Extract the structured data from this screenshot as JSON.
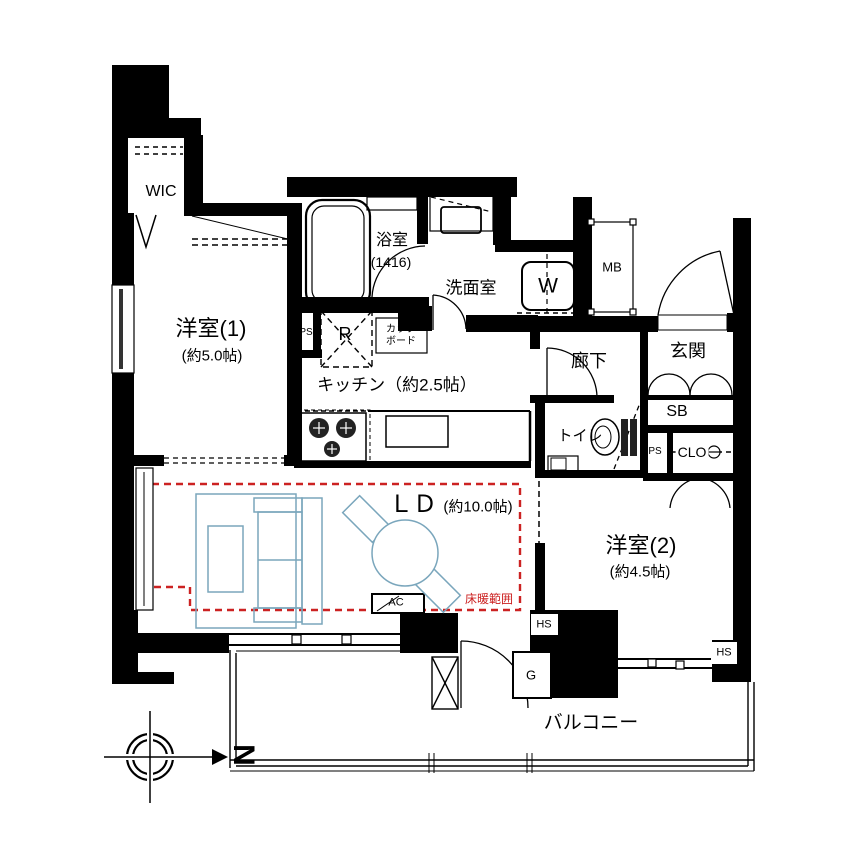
{
  "rooms": {
    "wic": {
      "label": "WIC"
    },
    "bedroom1": {
      "label": "洋室(1)",
      "size": "(約5.0帖)"
    },
    "bathroom": {
      "label": "浴室",
      "size": "(1416)"
    },
    "washroom": {
      "label": "洗面室"
    },
    "washing_machine": {
      "label": "W"
    },
    "meter_box": {
      "label": "MB"
    },
    "entrance": {
      "label": "玄関"
    },
    "hallway": {
      "label": "廊下"
    },
    "shoe_box": {
      "label": "SB"
    },
    "toilet": {
      "label": "トイレ"
    },
    "pipe_space_kitchen": {
      "label": "PS"
    },
    "pipe_space_hall": {
      "label": "PS"
    },
    "closet": {
      "label": "CLO"
    },
    "refrigerator_space": {
      "label": "R"
    },
    "cupboard": {
      "line1": "カップ",
      "line2": "ボード"
    },
    "kitchen": {
      "label": "キッチン（約2.5帖）"
    },
    "living_dining": {
      "label": "ＬＤ",
      "size": "(約10.0帖)"
    },
    "floor_heating": {
      "label": "床暖範囲"
    },
    "air_conditioner": {
      "label": "AC"
    },
    "bedroom2": {
      "label": "洋室(2)",
      "size": "(約4.5帖)"
    },
    "hose_spigot_left": {
      "label": "HS"
    },
    "hose_spigot_right": {
      "label": "HS"
    },
    "gas_meter": {
      "label": "G"
    },
    "balcony": {
      "label": "バルコニー"
    }
  },
  "compass": {
    "north_letter": "N"
  },
  "colors": {
    "wall": "#000000",
    "furniture_outline": "#7aa6bc",
    "floor_heating_border": "#cc2222"
  }
}
